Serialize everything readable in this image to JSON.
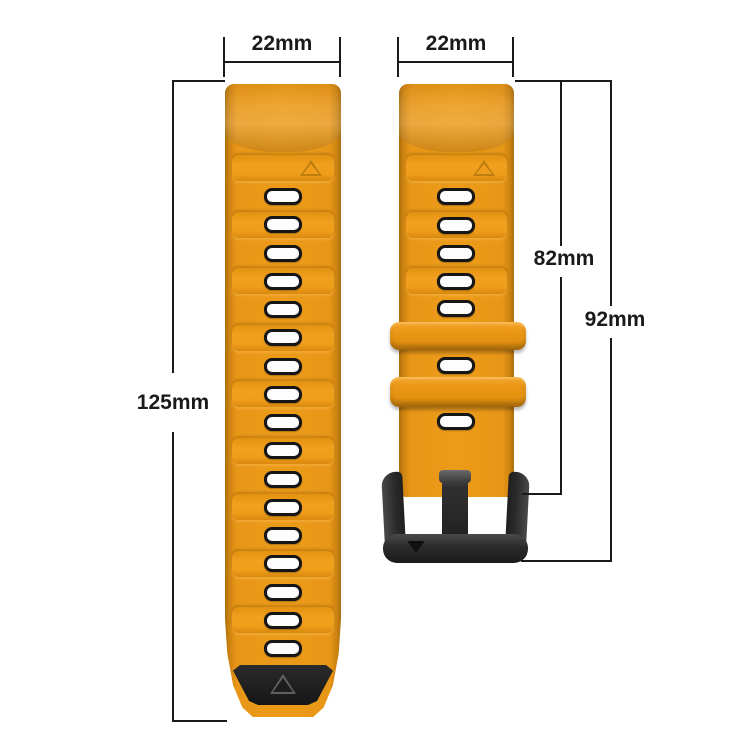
{
  "meta": {
    "description": "Silicone watch band size diagram, amber-orange two-piece strap with black pin buckle"
  },
  "colors": {
    "strap_orange": "#EC9B19",
    "strap_edge_shadow": "#A96E0C",
    "segment_highlight": "#F0A01E",
    "hole_fill": "#FDFDFD",
    "hole_border": "#161616",
    "tip_black": "#1D1D1D",
    "buckle_black": "#2A2A2A",
    "dimension_line": "#1A1A1A",
    "background": "#FFFFFF"
  },
  "dimensions": {
    "left_strap_width": "22mm",
    "right_strap_width": "22mm",
    "left_strap_length": "125mm",
    "right_strap_length": "82mm",
    "right_total_length": "92mm"
  },
  "left_strap": {
    "segment_count": 9,
    "hole_count": 17,
    "has_triangle_marker": true,
    "tip": "black rubber tip with embossed triangle"
  },
  "right_strap": {
    "segment_count": 3,
    "hole_count": 7,
    "keeper_count": 2,
    "has_triangle_marker": true,
    "buckle": "black pin buckle with down-arrow mark"
  }
}
